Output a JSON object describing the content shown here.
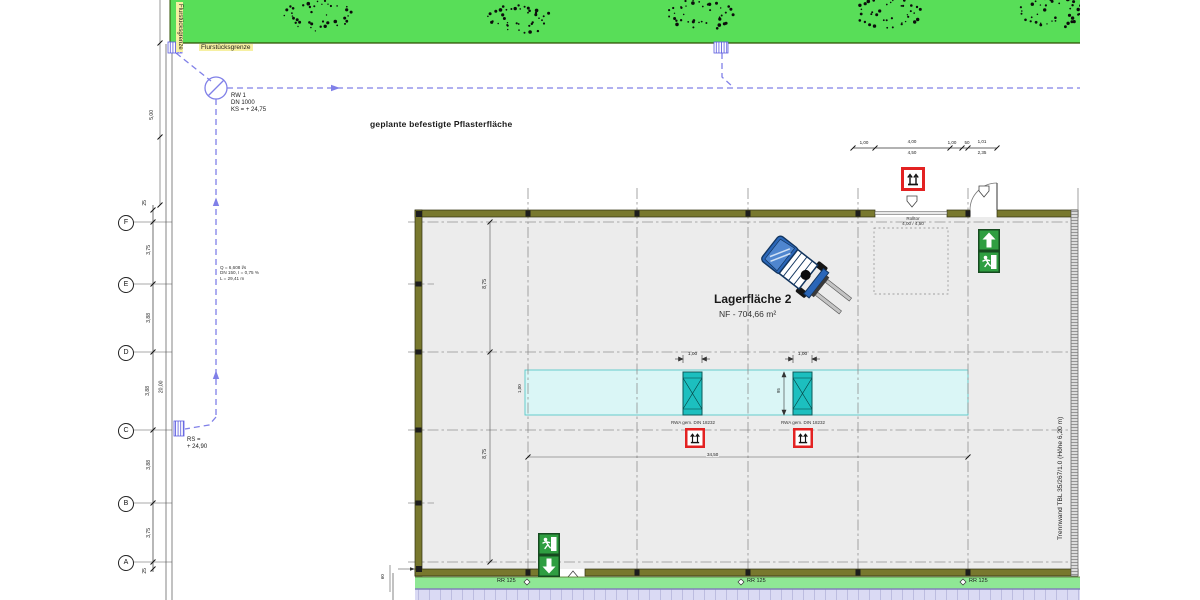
{
  "site": {
    "boundary_label": "Flurstücksgrenze",
    "paving_label": "geplante befestigte Pflasterfläche",
    "manhole_l1": "RW 1",
    "manhole_l2": "DN 1000",
    "manhole_l3": "KS = + 24,75",
    "pipe_l1": "Q = 6,608 l/s",
    "pipe_l2": "DN 150, I = 0,75 %",
    "pipe_l3": "L = 29,41 m",
    "outlet_l1": "RS =",
    "outlet_l2": "+ 24,90",
    "outer_dim": "5,00",
    "drain_label": "RR 125"
  },
  "grid": {
    "rows": [
      "F",
      "E",
      "D",
      "C",
      "B",
      "A"
    ],
    "seg_dims": [
      "25",
      "3,75",
      "3,88",
      "3,88",
      "3,88",
      "3,75",
      "25"
    ],
    "overall_dim": "20,00"
  },
  "hall": {
    "title": "Lagerfläche 2",
    "area": "NF - 704,66 m²",
    "partition_label": "Trennwand TBL 35/267/1.0 (Höhe 6,20 m)",
    "door_l1": "Rolltor",
    "door_l2": "4,00 / 4,50",
    "width_dim": "34,50",
    "height_dim_a": "8,75",
    "height_dim_b": "8,75",
    "band_dim": "1,00",
    "offset_dim": "60"
  },
  "rwa": {
    "label": "RWA gem. DIN 18232",
    "width_dim": "1,00",
    "gap_dim": "95"
  },
  "top_dims": [
    "1,00",
    "4,00",
    "4,50",
    "1,00",
    "50",
    "1,01",
    "2,35"
  ]
}
